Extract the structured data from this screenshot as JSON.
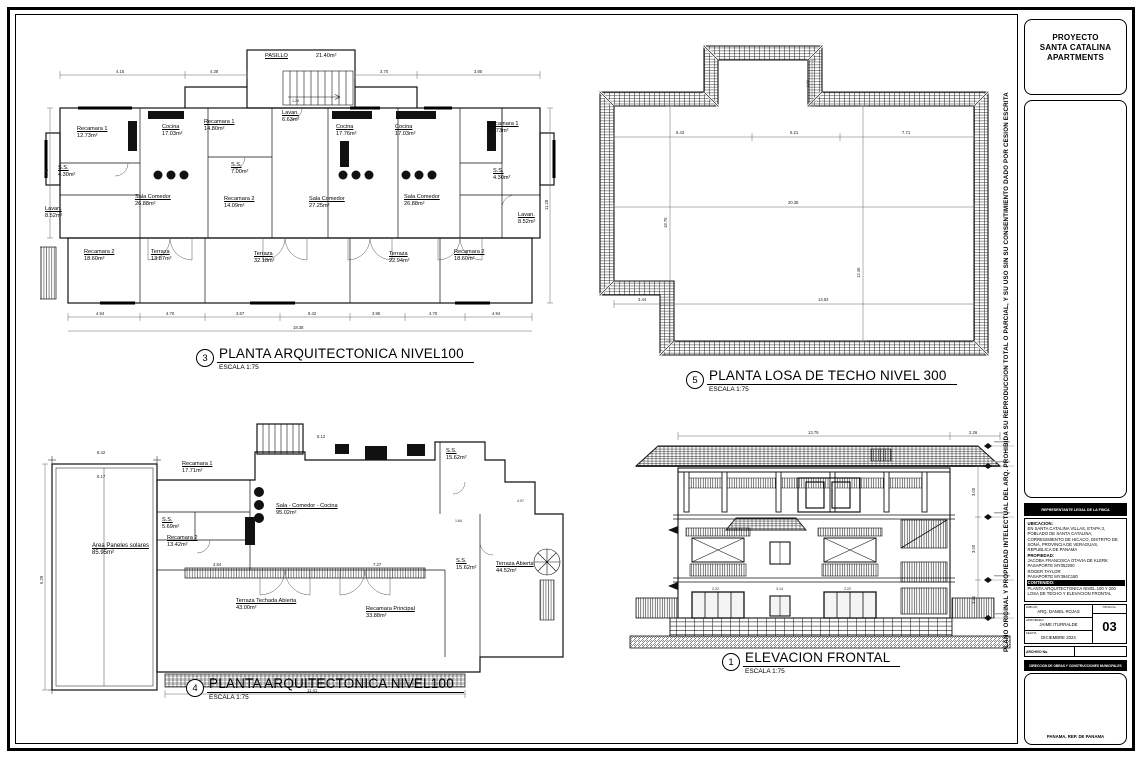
{
  "page": {
    "disclaimer_vertical": "PLANO ORIGINAL Y PROPIEDAD INTELECTUAL DEL ARQ. PROHIBIDA SU REPRODUCCION TOTAL O PARCIAL, Y SU USO SIN SU CONSENTIMIENTO DADO POR CESION ESCRITA"
  },
  "titleblock": {
    "project_lines": [
      "PROYECTO",
      "SANTA CATALINA",
      "APARTMENTS"
    ],
    "legal_header": "REPRESENTANTE LEGAL DE LA FINCA",
    "ubicacion_label": "UBICACION:",
    "ubicacion_lines": [
      "EN SANTA CATALINA VILLAS, ETAPA 3,",
      "POBLADO DE SANTA CATALINA,",
      "CORREGIMIENTO DE HICACO, DISTRITO DE",
      "SONÁ, PROVINCIA DE VERAGUAS,",
      "REPUBLICA DE PANAMA"
    ],
    "propiedad_label": "PROPIEDAD:",
    "propiedad_lines": [
      "JACOBA FRANCISCA OTAVIA DE KLERK",
      "PASAPORTE MY05J200",
      "ROGER TAYLOR",
      "PASAPORTE MY394C180"
    ],
    "contenido_label": "CONTENIDO:",
    "contenido_lines": [
      "PLANTA ARQUITECTONICA NIVEL 100 Y 200",
      "LOSA DE TECHO Y ELEVACION FRONTAL"
    ],
    "row_dibujo_label": "DIBUJO",
    "row_dibujo": "ARQ. DANIEL ROJAS",
    "row_aprobado_label": "APROBADO",
    "row_aprobado": "JAIME ITURRALDE",
    "row_fecha_label": "FECHA",
    "row_fecha": "DICIEMBRE 2024",
    "hoja_label": "HOJA No.",
    "hoja_num": "03",
    "archivo_label": "ARCHIVO No.",
    "hoja2_label": "HOJA No.",
    "hoja2": "A-03",
    "direccion": "DIRECCION DE OBRAS Y CONSTRUCCIONES MUNICIPALES",
    "footer": "PANAMA, REP. DE PANAMA"
  },
  "drawings": {
    "plan3": {
      "number": "3",
      "title": "PLANTA ARQUITECTONICA NIVEL100",
      "scale": "ESCALA 1:75",
      "rooms": [
        {
          "name": "PASILLO",
          "area": "21.40m²"
        },
        {
          "name": "Recamara 1",
          "area": "12.73m²"
        },
        {
          "name": "Cocina",
          "area": "17.03m²"
        },
        {
          "name": "Recamara 1",
          "area": "14.80m²"
        },
        {
          "name": "Lavan.",
          "area": "6.63m²"
        },
        {
          "name": "Cocina",
          "area": "17.76m²"
        },
        {
          "name": "Cocina",
          "area": "17.03m²"
        },
        {
          "name": "Recamara 1",
          "area": "12.73m²"
        },
        {
          "name": "S.S.",
          "area": "4.30m²"
        },
        {
          "name": "S.S.",
          "area": "7.00m²"
        },
        {
          "name": "S.S.",
          "area": "4.30m²"
        },
        {
          "name": "Lavan.",
          "area": "8.52m²"
        },
        {
          "name": "Sala Comedor",
          "area": "26.88m²"
        },
        {
          "name": "Recamara 2",
          "area": "14.09m²"
        },
        {
          "name": "Sala Comedor",
          "area": "27.25m²"
        },
        {
          "name": "Sala Comedor",
          "area": "26.88m²"
        },
        {
          "name": "Lavan.",
          "area": "8.52m²"
        },
        {
          "name": "Recamara 2",
          "area": "18.60m²"
        },
        {
          "name": "Terraza",
          "area": "13.87m²"
        },
        {
          "name": "Terraza",
          "area": "32.18m²"
        },
        {
          "name": "Terraza",
          "area": "22.94m²"
        },
        {
          "name": "Recamara 2",
          "area": "18.60m²"
        }
      ],
      "dims_top": [
        "4.15",
        "4.38",
        "3.70",
        "3.85",
        "1.24"
      ],
      "dims_bottom": [
        "4.94",
        "4.70",
        "3.67",
        "8.42",
        "3.95",
        "4.70",
        "4.94"
      ],
      "dim_total": "18.38",
      "dim_left": "4.40",
      "dim_right": "11.28"
    },
    "roof5": {
      "number": "5",
      "title": "PLANTA  LOSA DE TECHO NIVEL 300",
      "scale": "ESCALA 1:75",
      "dims_top": [
        "6.43",
        "6.21",
        "7.71"
      ],
      "dim_mid": "20.35",
      "dims_bottom": [
        "3.44",
        "14.92"
      ],
      "dim_left": "18.75",
      "dim_right": "12.46",
      "dim_notch": "1.98"
    },
    "plan4": {
      "number": "4",
      "title": "PLANTA ARQUITECTONICA NIVEL100",
      "scale": "ESCALA 1:75",
      "rooms": [
        {
          "name": "Area Paneles solares",
          "area": "85.95m²"
        },
        {
          "name": "Recamara 1",
          "area": "17.71m²"
        },
        {
          "name": "S.S.",
          "area": "5.69m²"
        },
        {
          "name": "Recamara 2",
          "area": "13.42m²"
        },
        {
          "name": "Sala - Comedor - Cocina",
          "area": "95.02m²"
        },
        {
          "name": "S.S.",
          "area": "15.62m²"
        },
        {
          "name": "S.S.",
          "area": "15.62m²"
        },
        {
          "name": "Terraza Abierta",
          "area": "44.52m²"
        },
        {
          "name": "Terraza Techada Abierta",
          "area": "43.00m²"
        },
        {
          "name": "Recamara Principal",
          "area": "33.88m²"
        }
      ],
      "dims": [
        "6.42",
        "6.17",
        "6.29",
        "11.41",
        "7.27",
        "4.84",
        "5.12",
        "1.64",
        "4.07"
      ]
    },
    "elev1": {
      "number": "1",
      "title": "ELEVACION FRONTAL",
      "scale": "ESCALA 1:75",
      "dims_top": [
        "13.79",
        "2.26"
      ],
      "dims_right": [
        "3.00",
        "3.00",
        "3.51"
      ],
      "dims_mid": [
        "2.22",
        "3.14",
        "2.22"
      ]
    }
  }
}
